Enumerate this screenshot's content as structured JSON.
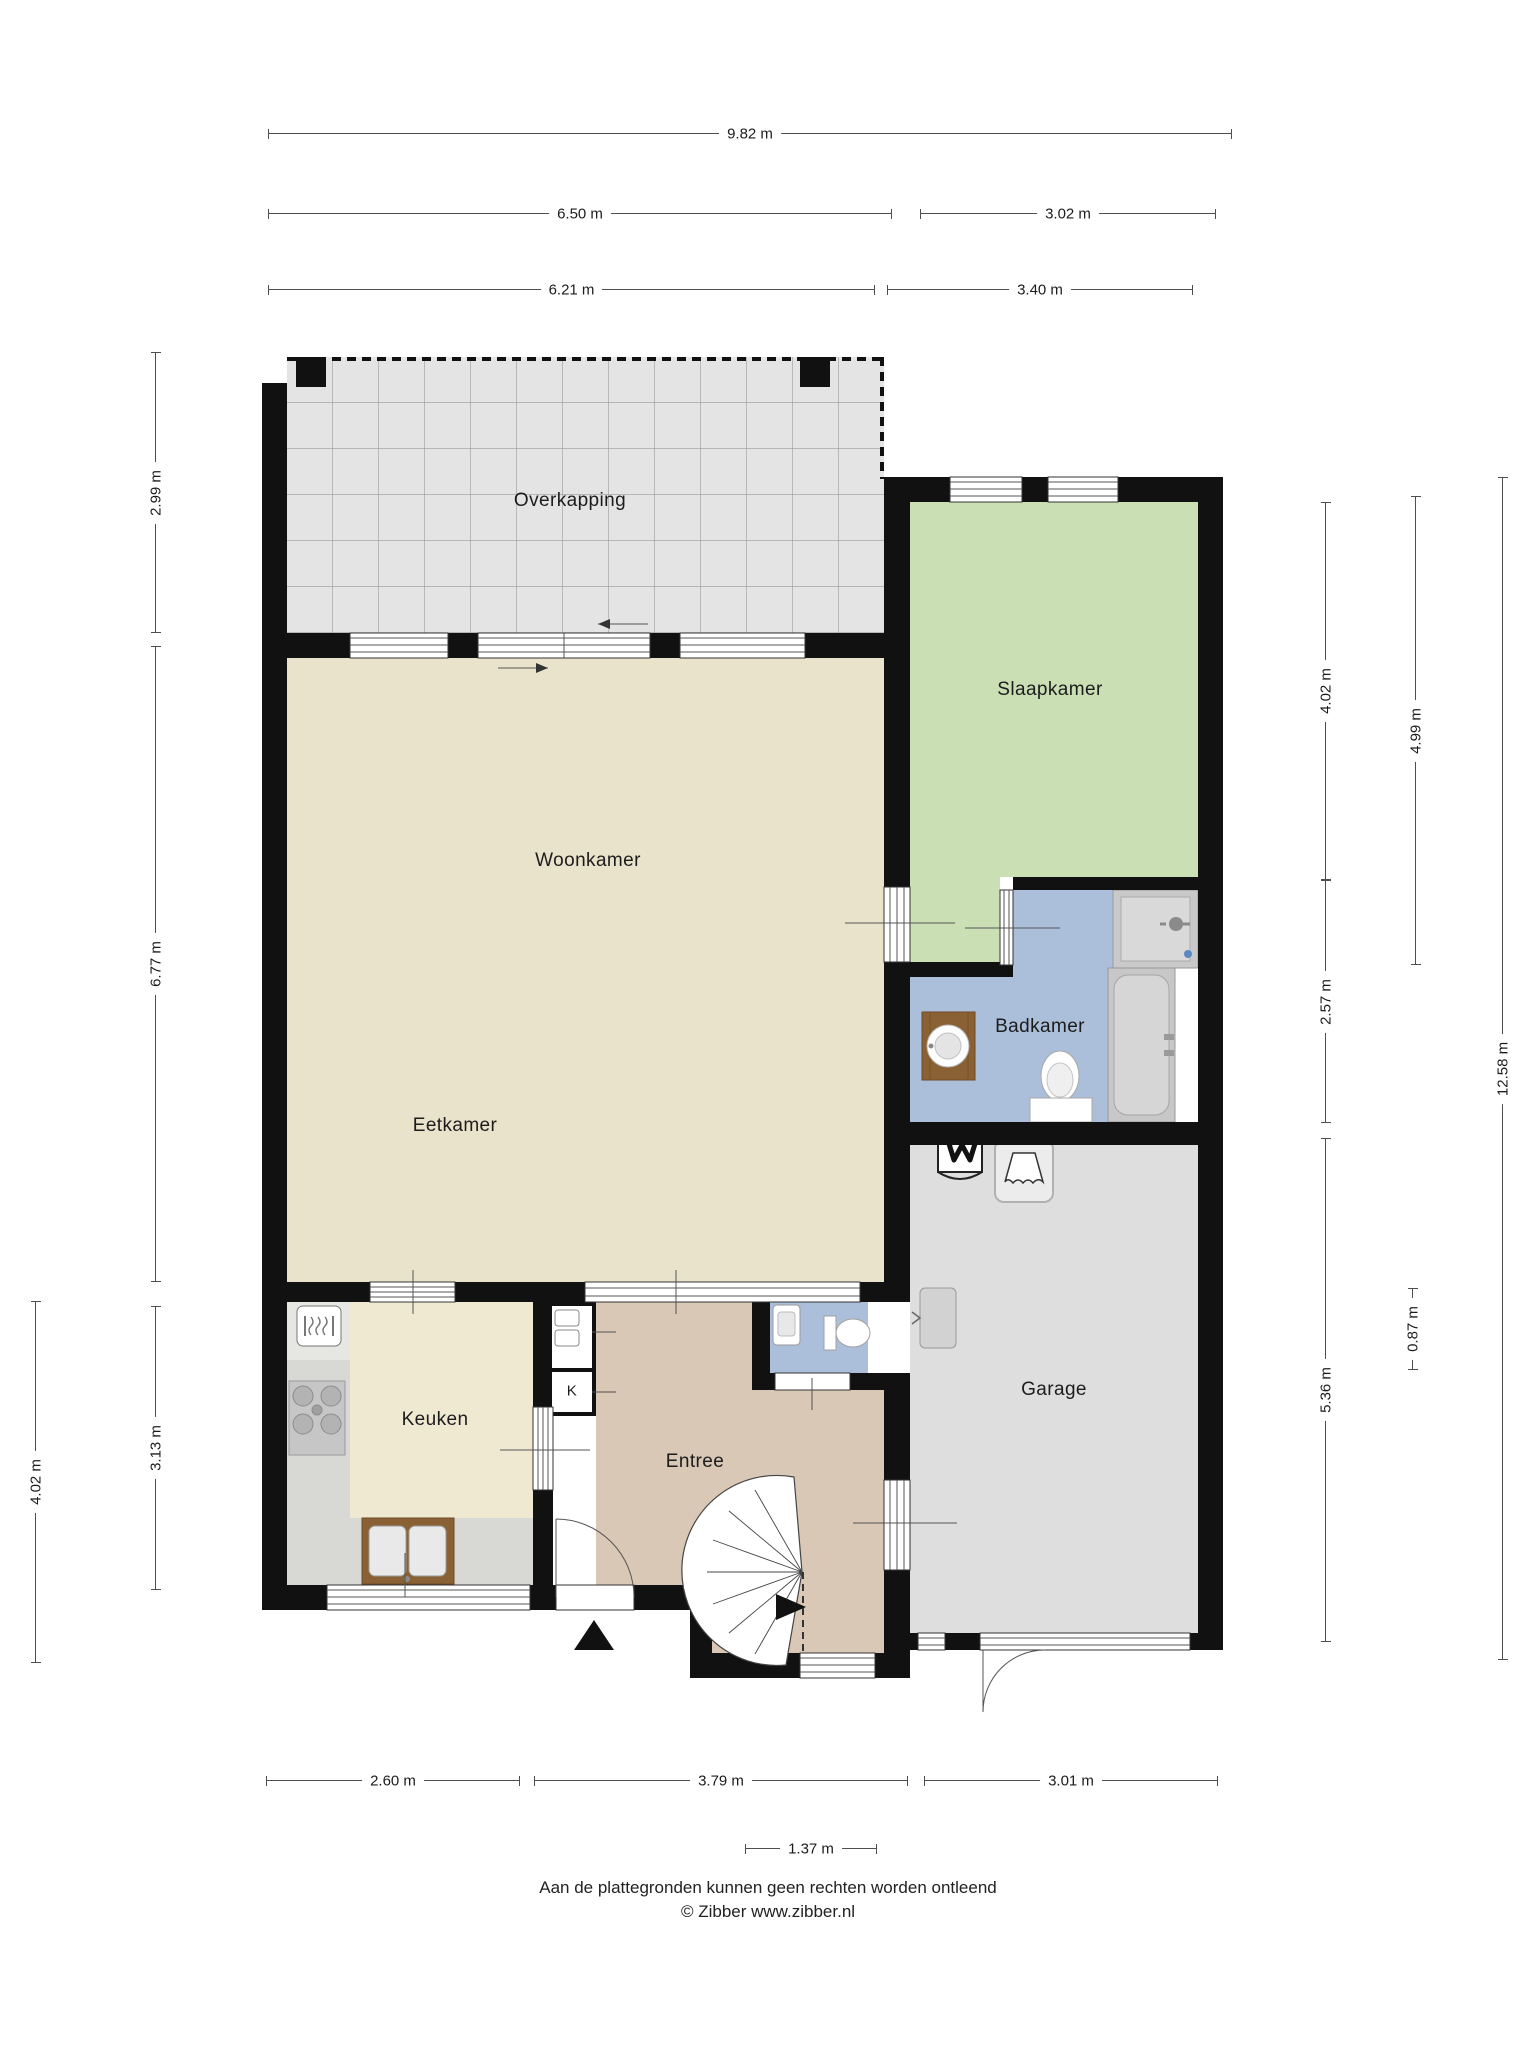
{
  "rooms": {
    "overkapping": {
      "label": "Overkapping"
    },
    "woonkamer": {
      "label": "Woonkamer"
    },
    "eetkamer": {
      "label": "Eetkamer"
    },
    "slaapkamer": {
      "label": "Slaapkamer"
    },
    "badkamer": {
      "label": "Badkamer"
    },
    "keuken": {
      "label": "Keuken"
    },
    "entree": {
      "label": "Entree"
    },
    "garage": {
      "label": "Garage"
    },
    "kast": {
      "label": "K"
    }
  },
  "dimensions": {
    "top": [
      {
        "label": "9.82 m"
      },
      {
        "label": "6.50 m"
      },
      {
        "label": "3.02 m"
      },
      {
        "label": "6.21 m"
      },
      {
        "label": "3.40 m"
      }
    ],
    "left": [
      {
        "label": "2.99 m"
      },
      {
        "label": "6.77 m"
      },
      {
        "label": "3.13 m"
      },
      {
        "label": "4.02 m"
      }
    ],
    "right": [
      {
        "label": "4.02 m"
      },
      {
        "label": "2.57 m"
      },
      {
        "label": "5.36 m"
      },
      {
        "label": "4.99 m"
      },
      {
        "label": "0.87 m"
      },
      {
        "label": "12.58 m"
      }
    ],
    "bottom": [
      {
        "label": "2.60 m"
      },
      {
        "label": "3.79 m"
      },
      {
        "label": "3.01 m"
      },
      {
        "label": "1.37 m"
      }
    ]
  },
  "footer": {
    "disclaimer": "Aan de plattegronden kunnen geen rechten worden ontleend",
    "credit": "© Zibber www.zibber.nl"
  },
  "colors": {
    "wall": "#111111",
    "living_floor": "#eae3cb",
    "kitchen_floor": "#f0e9d2",
    "entry_floor": "#d8c8b5",
    "bedroom_floor": "#cbdfb5",
    "bathroom_floor": "#abbfda",
    "garage_floor": "#dedede",
    "terrace_tiles": "#e4e4e4"
  }
}
